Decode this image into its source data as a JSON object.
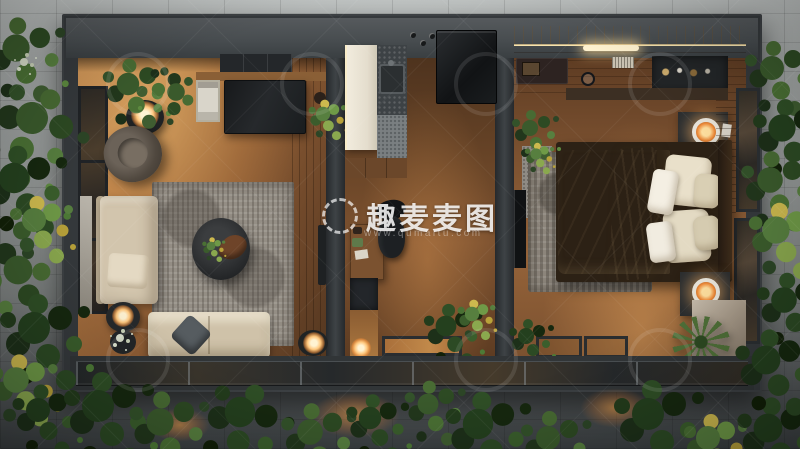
{
  "watermark": {
    "icon_name": "laurel-wreath-icon",
    "brand": "趣麦麦图",
    "url": "www.qumaitu.com"
  },
  "scene": {
    "rooms": [
      "living-room",
      "kitchen-office",
      "bedroom"
    ]
  },
  "palette": {
    "frame_charcoal": "#35393c",
    "tile_light": "#b5b9b8",
    "tile_dark": "#3a3f41",
    "wood_warm": "#a9713f",
    "wood_dark": "#5e3c23",
    "sofa_beige": "#d2c5ad",
    "bedding_cream": "#e9e0ca",
    "rug_gray": "#948e85",
    "plant_green": "#3a5a2c",
    "lamp_glow": "#ffc87e"
  }
}
